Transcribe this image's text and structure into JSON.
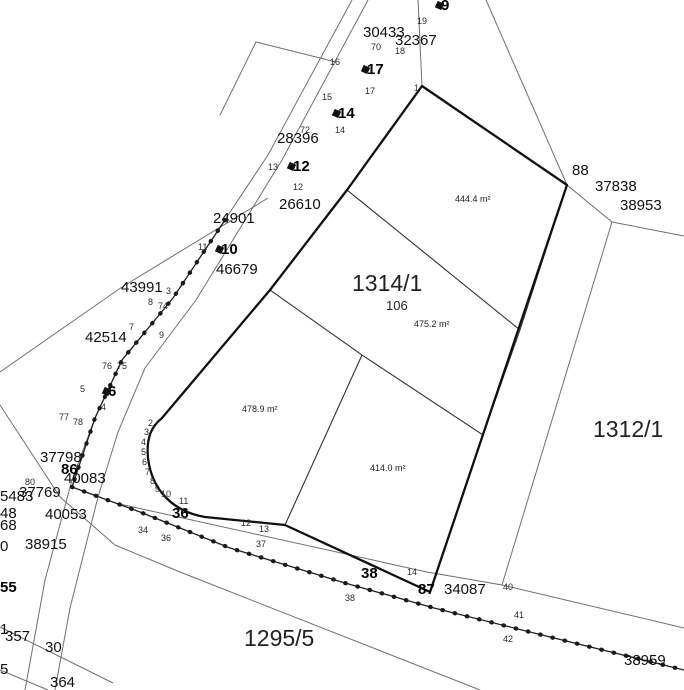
{
  "colors": {
    "cyan": "#c9f5f3",
    "pink": "#f9d7ee",
    "yellow": "#fcfac8",
    "green": "#def8dc",
    "outline": "#101010",
    "fence": "#1a1a1a"
  },
  "labels": [
    {
      "text": "1314/1",
      "x": 352,
      "y": 272,
      "kind": "parcel",
      "name": "parcel-label-1314-1"
    },
    {
      "text": "1312/1",
      "x": 593,
      "y": 418,
      "kind": "parcel",
      "name": "parcel-label-1312-1"
    },
    {
      "text": "1295/5",
      "x": 244,
      "y": 627,
      "kind": "parcel",
      "name": "parcel-label-1295-5"
    },
    {
      "text": "106",
      "x": 386,
      "y": 299,
      "kind": "sub",
      "name": "parcel-sublabel-106"
    },
    {
      "text": "444.4 m²",
      "x": 455,
      "y": 195,
      "kind": "area",
      "name": "area-label-cyan"
    },
    {
      "text": "475.2 m²",
      "x": 414,
      "y": 320,
      "kind": "area",
      "name": "area-label-pink"
    },
    {
      "text": "478.9 m²",
      "x": 242,
      "y": 405,
      "kind": "area",
      "name": "area-label-yellow"
    },
    {
      "text": "414.0 m²",
      "x": 370,
      "y": 464,
      "kind": "area",
      "name": "area-label-green"
    },
    {
      "text": "30433",
      "x": 363,
      "y": 25,
      "kind": "survey"
    },
    {
      "text": "32367",
      "x": 395,
      "y": 33,
      "kind": "survey"
    },
    {
      "text": "28396",
      "x": 277,
      "y": 131,
      "kind": "survey"
    },
    {
      "text": "26610",
      "x": 279,
      "y": 197,
      "kind": "survey"
    },
    {
      "text": "24901",
      "x": 213,
      "y": 211,
      "kind": "survey"
    },
    {
      "text": "46679",
      "x": 216,
      "y": 262,
      "kind": "survey"
    },
    {
      "text": "43991",
      "x": 121,
      "y": 280,
      "kind": "survey"
    },
    {
      "text": "42514",
      "x": 85,
      "y": 330,
      "kind": "survey"
    },
    {
      "text": "37798",
      "x": 40,
      "y": 450,
      "kind": "survey"
    },
    {
      "text": "40083",
      "x": 64,
      "y": 471,
      "kind": "survey"
    },
    {
      "text": "37769",
      "x": 19,
      "y": 485,
      "kind": "survey"
    },
    {
      "text": "5483",
      "x": 0,
      "y": 489,
      "kind": "survey"
    },
    {
      "text": "40053",
      "x": 45,
      "y": 507,
      "kind": "survey"
    },
    {
      "text": "38915",
      "x": 25,
      "y": 537,
      "kind": "survey"
    },
    {
      "text": "37838",
      "x": 595,
      "y": 179,
      "kind": "survey"
    },
    {
      "text": "38953",
      "x": 620,
      "y": 198,
      "kind": "survey"
    },
    {
      "text": "88",
      "x": 572,
      "y": 163,
      "kind": "survey"
    },
    {
      "text": "34087",
      "x": 444,
      "y": 582,
      "kind": "survey"
    },
    {
      "text": "38959",
      "x": 624,
      "y": 653,
      "kind": "survey"
    },
    {
      "text": "357",
      "x": 5,
      "y": 629,
      "kind": "survey"
    },
    {
      "text": "30",
      "x": 45,
      "y": 640,
      "kind": "survey"
    },
    {
      "text": "364",
      "x": 50,
      "y": 675,
      "kind": "survey"
    },
    {
      "text": "48",
      "x": 0,
      "y": 506,
      "kind": "survey"
    },
    {
      "text": "68",
      "x": 0,
      "y": 518,
      "kind": "survey"
    },
    {
      "text": "0",
      "x": 0,
      "y": 539,
      "kind": "survey"
    },
    {
      "text": "1",
      "x": 0,
      "y": 622,
      "kind": "survey"
    },
    {
      "text": "5",
      "x": 0,
      "y": 662,
      "kind": "survey"
    },
    {
      "text": "9",
      "x": 441,
      "y": -2,
      "kind": "bold",
      "marker": true
    },
    {
      "text": "17",
      "x": 367,
      "y": 62,
      "kind": "bold",
      "marker": true
    },
    {
      "text": "14",
      "x": 338,
      "y": 106,
      "kind": "bold",
      "marker": true
    },
    {
      "text": "12",
      "x": 293,
      "y": 159,
      "kind": "bold",
      "marker": true
    },
    {
      "text": "10",
      "x": 221,
      "y": 242,
      "kind": "bold",
      "marker": true
    },
    {
      "text": "6",
      "x": 108,
      "y": 384,
      "kind": "bold",
      "marker": true
    },
    {
      "text": "86",
      "x": 61,
      "y": 462,
      "kind": "bold"
    },
    {
      "text": "36",
      "x": 172,
      "y": 506,
      "kind": "bold"
    },
    {
      "text": "38",
      "x": 361,
      "y": 566,
      "kind": "bold"
    },
    {
      "text": "87",
      "x": 418,
      "y": 582,
      "kind": "bold"
    },
    {
      "text": "55",
      "x": 0,
      "y": 580,
      "kind": "bold"
    },
    {
      "text": "1",
      "x": 414,
      "y": 84,
      "kind": "point"
    },
    {
      "text": "19",
      "x": 417,
      "y": 17,
      "kind": "point"
    },
    {
      "text": "70",
      "x": 371,
      "y": 43,
      "kind": "point"
    },
    {
      "text": "18",
      "x": 395,
      "y": 47,
      "kind": "point"
    },
    {
      "text": "16",
      "x": 330,
      "y": 58,
      "kind": "point"
    },
    {
      "text": "17",
      "x": 365,
      "y": 87,
      "kind": "point"
    },
    {
      "text": "15",
      "x": 322,
      "y": 93,
      "kind": "point"
    },
    {
      "text": "72",
      "x": 300,
      "y": 126,
      "kind": "point"
    },
    {
      "text": "14",
      "x": 335,
      "y": 126,
      "kind": "point"
    },
    {
      "text": "13",
      "x": 268,
      "y": 163,
      "kind": "point"
    },
    {
      "text": "12",
      "x": 293,
      "y": 183,
      "kind": "point"
    },
    {
      "text": "11",
      "x": 198,
      "y": 243,
      "kind": "point"
    },
    {
      "text": "3",
      "x": 166,
      "y": 287,
      "kind": "point"
    },
    {
      "text": "8",
      "x": 148,
      "y": 298,
      "kind": "point"
    },
    {
      "text": "74",
      "x": 158,
      "y": 302,
      "kind": "point"
    },
    {
      "text": "7",
      "x": 129,
      "y": 323,
      "kind": "point"
    },
    {
      "text": "9",
      "x": 159,
      "y": 331,
      "kind": "point"
    },
    {
      "text": "76",
      "x": 102,
      "y": 362,
      "kind": "point"
    },
    {
      "text": "75",
      "x": 117,
      "y": 362,
      "kind": "point"
    },
    {
      "text": "5",
      "x": 80,
      "y": 385,
      "kind": "point"
    },
    {
      "text": "4",
      "x": 101,
      "y": 403,
      "kind": "point"
    },
    {
      "text": "77",
      "x": 59,
      "y": 413,
      "kind": "point"
    },
    {
      "text": "78",
      "x": 73,
      "y": 418,
      "kind": "point"
    },
    {
      "text": "80",
      "x": 25,
      "y": 478,
      "kind": "point"
    },
    {
      "text": "2",
      "x": 148,
      "y": 419,
      "kind": "point"
    },
    {
      "text": "3",
      "x": 144,
      "y": 428,
      "kind": "point"
    },
    {
      "text": "4",
      "x": 141,
      "y": 438,
      "kind": "point"
    },
    {
      "text": "5",
      "x": 141,
      "y": 448,
      "kind": "point"
    },
    {
      "text": "6",
      "x": 142,
      "y": 458,
      "kind": "point"
    },
    {
      "text": "7",
      "x": 145,
      "y": 468,
      "kind": "point"
    },
    {
      "text": "8",
      "x": 150,
      "y": 477,
      "kind": "point"
    },
    {
      "text": "9",
      "x": 155,
      "y": 485,
      "kind": "point"
    },
    {
      "text": "10",
      "x": 161,
      "y": 490,
      "kind": "point"
    },
    {
      "text": "11",
      "x": 179,
      "y": 497,
      "kind": "point"
    },
    {
      "text": "12",
      "x": 241,
      "y": 519,
      "kind": "point"
    },
    {
      "text": "13",
      "x": 259,
      "y": 525,
      "kind": "point"
    },
    {
      "text": "34",
      "x": 138,
      "y": 526,
      "kind": "point"
    },
    {
      "text": "36",
      "x": 161,
      "y": 534,
      "kind": "point"
    },
    {
      "text": "37",
      "x": 256,
      "y": 540,
      "kind": "point"
    },
    {
      "text": "38",
      "x": 345,
      "y": 594,
      "kind": "point"
    },
    {
      "text": "14",
      "x": 407,
      "y": 568,
      "kind": "point"
    },
    {
      "text": "40",
      "x": 503,
      "y": 583,
      "kind": "point"
    },
    {
      "text": "41",
      "x": 514,
      "y": 611,
      "kind": "point"
    },
    {
      "text": "42",
      "x": 503,
      "y": 635,
      "kind": "point"
    }
  ]
}
